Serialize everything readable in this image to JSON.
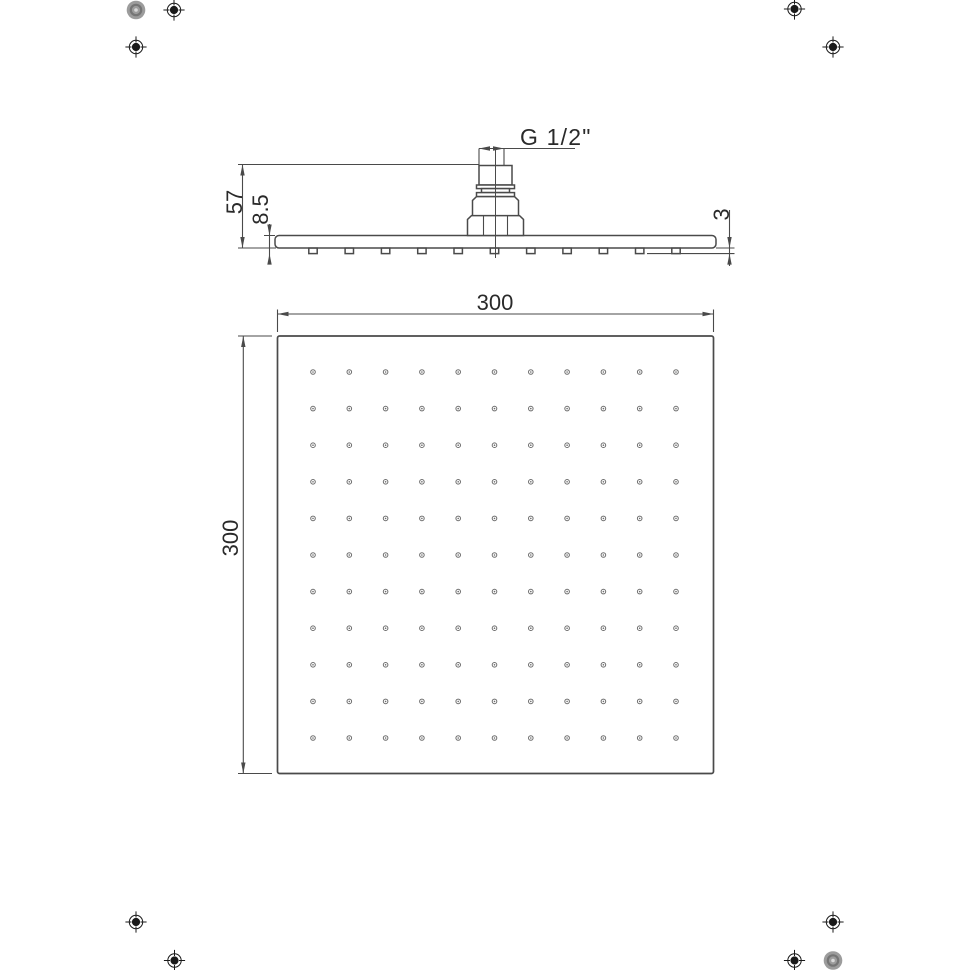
{
  "colors": {
    "background": "#ffffff",
    "line": "#4a4a4a",
    "text": "#2a2a2a",
    "nozzle_dot": "#6e6e6e",
    "registration_black": "#1a1a1a",
    "registration_gray": "#9c9c9c"
  },
  "side_view": {
    "thread_label": "G 1/2\"",
    "overall_height": "57",
    "head_thickness": "8.5",
    "nozzle_protrusion": "3",
    "nozzle_count": 11
  },
  "bottom_view": {
    "width_label": "300",
    "height_label": "300",
    "nozzle_grid": {
      "cols": 11,
      "rows": 11
    }
  },
  "print_marks": {
    "registration_target_icon": "registration-target",
    "halftone_dot_icon": "halftone-dot",
    "registration_target_count": 8,
    "halftone_dot_count": 2
  }
}
